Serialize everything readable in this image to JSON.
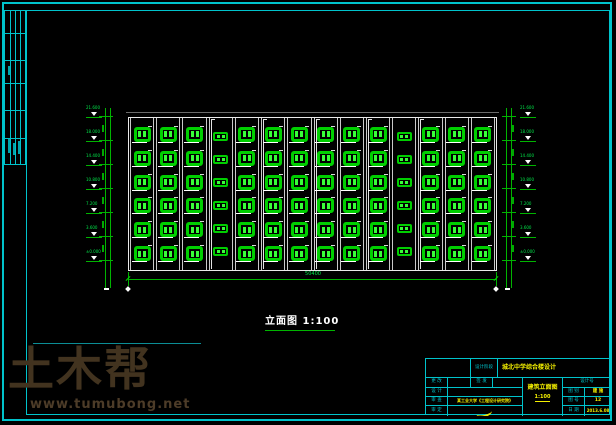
{
  "colors": {
    "frame": "#00c3cb",
    "window_green": "#00cf00",
    "dimension_green": "#00b400",
    "value_yellow": "#f4f000",
    "watermark_brown": "#42331f"
  },
  "watermark": {
    "brand": "土木帮",
    "url": "www.tumubong.net"
  },
  "drawing": {
    "title": "立面图 1:100",
    "total_dim": "50400",
    "floors": 6,
    "bays": [
      {
        "type": "large"
      },
      {
        "type": "large"
      },
      {
        "type": "large"
      },
      {
        "type": "small",
        "pipe": true
      },
      {
        "type": "large"
      },
      {
        "type": "large",
        "pipe": true
      },
      {
        "type": "large"
      },
      {
        "type": "large",
        "pipe": true
      },
      {
        "type": "large"
      },
      {
        "type": "large",
        "pipe": true
      },
      {
        "type": "small"
      },
      {
        "type": "large",
        "pipe": true
      },
      {
        "type": "large"
      },
      {
        "type": "large"
      }
    ],
    "levels": [
      "21.600",
      "18.000",
      "14.400",
      "10.800",
      "7.200",
      "3.600",
      "±0.000"
    ]
  },
  "title_block": {
    "stage_label": "设计阶段",
    "project": "城北中学综合楼设计",
    "left_rows": [
      {
        "label": "更 改",
        "label2": "签 发",
        "value": ""
      },
      {
        "label": "设 计",
        "value": ""
      },
      {
        "label": "审 查",
        "value": "某工业大学《工程设计研究院》"
      },
      {
        "label": "审 定",
        "value": ""
      }
    ],
    "drawing_name": "建筑立面图",
    "scale": "1:100",
    "design_no_label": "设计号",
    "right_rows": [
      {
        "label": "图 别",
        "value": "建 施"
      },
      {
        "label": "图 号",
        "value": "12"
      },
      {
        "label": "日 期",
        "value": "2013.6.08"
      }
    ]
  }
}
